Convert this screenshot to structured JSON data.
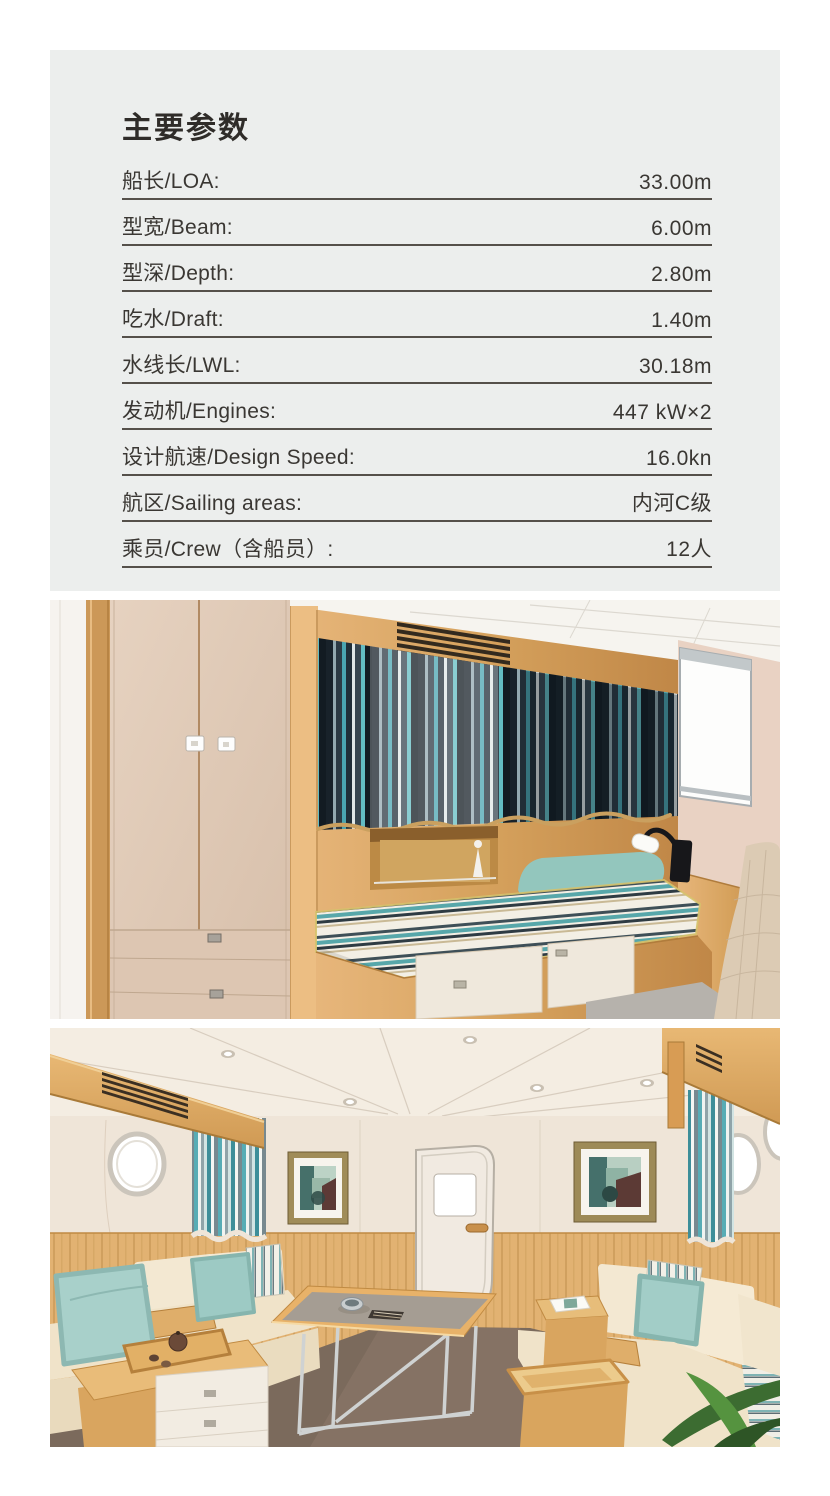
{
  "spec_card": {
    "title": "主要参数",
    "background": "#eceeed",
    "rows": [
      {
        "label": "船长/LOA:",
        "value": "33.00m"
      },
      {
        "label": "型宽/Beam:",
        "value": "6.00m"
      },
      {
        "label": "型深/Depth:",
        "value": "2.80m"
      },
      {
        "label": "吃水/Draft:",
        "value": "1.40m"
      },
      {
        "label": "水线长/LWL:",
        "value": "30.18m"
      },
      {
        "label": "发动机/Engines:",
        "value": "447 kW×2"
      },
      {
        "label": "设计航速/Design Speed:",
        "value": "16.0kn"
      },
      {
        "label": "航区/Sailing areas:",
        "value": "内河C级"
      },
      {
        "label": "乘员/Crew（含船员）:",
        "value": "12人"
      }
    ]
  },
  "photos": [
    {
      "name": "cabin-bedroom-render",
      "description": "Guest cabin render: wardrobe, striped curtains, single berth with teal pillow, reading lamp, window"
    },
    {
      "name": "salon-render",
      "description": "Salon render: portholes, striped curtains, framed art, door, cream sofas with teal pillows, dining table, plant"
    }
  ],
  "palette": {
    "wood": "#d6a25d",
    "teal_accent": "#57a7aa",
    "curtain_dark": "#202e38",
    "cream_wall": "#efe5d8",
    "floor_salon": "#7b6a5c",
    "text": "#3a3733"
  }
}
